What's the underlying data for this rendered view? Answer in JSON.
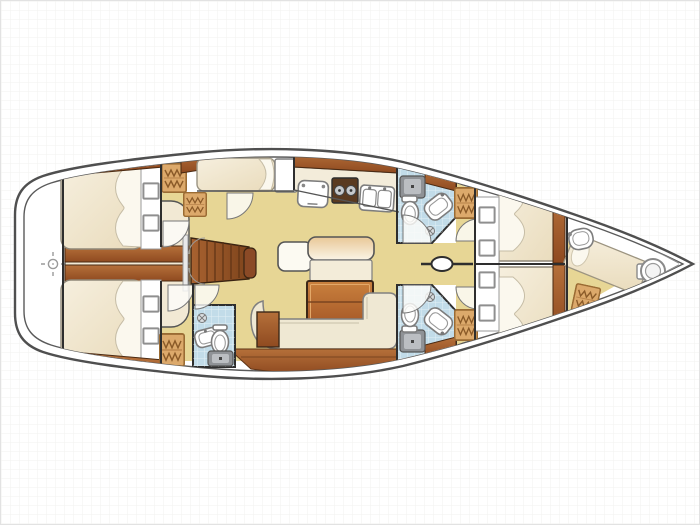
{
  "title": "sailing-yacht-interior-floor-plan",
  "diagram": {
    "type": "boat-deck-floor-plan",
    "view": "top-down",
    "bow_direction": "right",
    "stern_direction": "left",
    "sections": [
      {
        "name": "stern-platform",
        "features": [
          "datum-crosshair-marker"
        ]
      },
      {
        "name": "aft-cabin-port",
        "features": [
          "double-berth",
          "pillows",
          "storage-squares",
          "hanging-locker",
          "hull-side-shelf"
        ]
      },
      {
        "name": "aft-cabin-starboard",
        "features": [
          "double-berth",
          "pillows",
          "storage-squares",
          "hanging-locker",
          "hull-side-shelf"
        ]
      },
      {
        "name": "engine-compartment",
        "features": [
          "wood-planks"
        ]
      },
      {
        "name": "companionway",
        "features": [
          "wood-steps",
          "hand-rails",
          "double-door"
        ]
      },
      {
        "name": "nav-station",
        "features": [
          "seat-berth",
          "chart-table",
          "locker"
        ]
      },
      {
        "name": "galley",
        "features": [
          "top-load-fridge",
          "two-burner-stove",
          "double-sink",
          "counter"
        ]
      },
      {
        "name": "saloon",
        "features": [
          "armchair",
          "sofa-cushion",
          "dining-table",
          "l-settee",
          "side-cabinet",
          "wood-sole"
        ]
      },
      {
        "name": "aft-head",
        "features": [
          "wash-basin",
          "toilet",
          "shower-tray",
          "door"
        ]
      },
      {
        "name": "forward-head-port",
        "features": [
          "shower-tray",
          "toilet",
          "wash-basin",
          "door"
        ]
      },
      {
        "name": "forward-head-starboard",
        "features": [
          "shower-tray",
          "toilet",
          "wash-basin",
          "door"
        ]
      },
      {
        "name": "mast-station",
        "features": [
          "mast",
          "centerline-beam"
        ]
      },
      {
        "name": "forward-cabin-port",
        "features": [
          "double-berth",
          "pillows",
          "storage-squares",
          "door"
        ]
      },
      {
        "name": "forward-cabin-starboard",
        "features": [
          "double-berth",
          "pillows",
          "storage-squares",
          "door"
        ]
      },
      {
        "name": "crew-cabin-bow",
        "features": [
          "wash-basin",
          "berth",
          "hanging-locker",
          "toilet"
        ]
      },
      {
        "name": "anchor-locker",
        "features": []
      }
    ]
  },
  "palette": {
    "background": "#FFFFFF",
    "gridLine": "#F2F2EF",
    "hullOutline": "#4F4F4F",
    "outlineDark": "#2E2E2E",
    "floorYellow": "#E7D695",
    "cream": "#F2E9D4",
    "berthCream": "#F4ECDA",
    "pillowWhite": "#FBF8EE",
    "woodDark": "#9A5328",
    "woodMid": "#B5692F",
    "woodLight": "#C9813E",
    "tanLocker": "#DCA96B",
    "headFloorBlue": "#C2DCE9",
    "showerGray": "#8F9296",
    "fixtureWhite": "#FFFFFF"
  }
}
